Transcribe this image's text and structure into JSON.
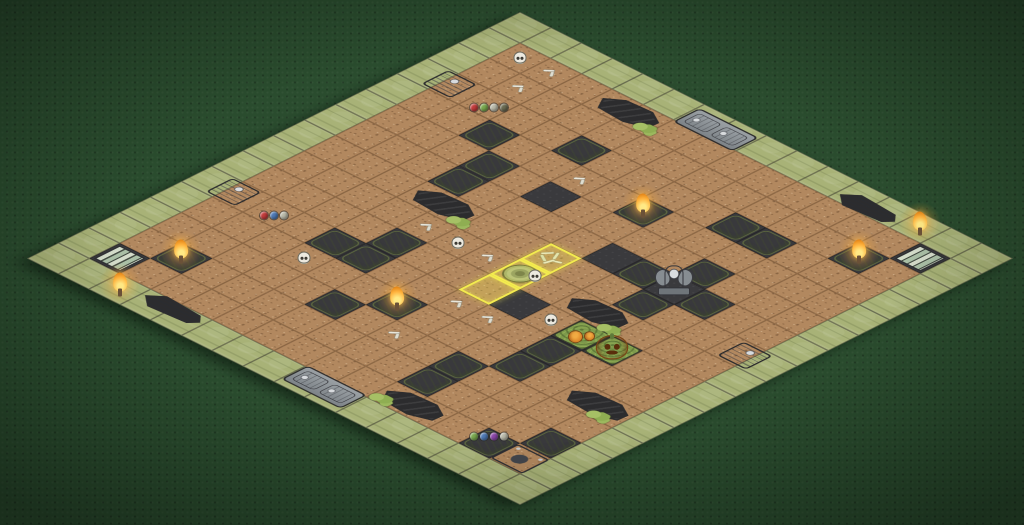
{
  "scene": {
    "description": "Isometric graveyard battle board on a dark green felt table",
    "board_theme": "graveyard",
    "grid_size": 16
  },
  "colors": {
    "felt": "#2a4c2e",
    "dirt": "#b2885f",
    "dark_square": "#3a3a3d",
    "moss_green": "#a8b277",
    "board_rim": "#2c2c2e",
    "board_edge_side": "#c8bda2",
    "water": "#6f7e89",
    "stone_gray": "#8f969c",
    "highlight_yellow": "#f4ec4f",
    "flame_orange": "#f5a02c",
    "pumpkin_orange": "#e89130"
  },
  "board": {
    "legend": {
      "E": "edge-moss-border",
      ".": "open-dirt",
      "D": "dark-blocked-square",
      "G": "moss-square",
      "T": "torch-moss-square",
      "S": "gate-striped-square",
      "P": "pumpkin-patch-square"
    },
    "rows": [
      "EEEEEEEEEEEEEEEE",
      "E.............SE",
      "E............T.E",
      "E....G....GG...E",
      "E..G....T......E",
      "E...G.D....G...E",
      "E...G....DGDG..E",
      "E..........G...E",
      "E..............E",
      "E....G...D.PP..E",
      "E...GG.....G...E",
      "E......T...G...E",
      "E.....G...G....E",
      "E.T.......G...GE",
      "ES...........G.E",
      "EEEEEEEEEEEEEEEE"
    ]
  },
  "highlight": {
    "color": "#f4ec4f",
    "cells": [
      {
        "i": 7,
        "j": 8,
        "content": "bone-pile"
      },
      {
        "i": 8,
        "j": 8,
        "content": "stone-well"
      },
      {
        "i": 9,
        "j": 8,
        "content": "empty"
      }
    ]
  },
  "flat_decorations": [
    {
      "kind": "pond",
      "i": 1,
      "j": 4,
      "dx": 0.5
    },
    {
      "kind": "pond",
      "i": 7,
      "j": 4,
      "dx": 0.5
    },
    {
      "kind": "pond",
      "i": 8,
      "j": 10,
      "dx": 0.5
    },
    {
      "kind": "pond",
      "i": 11,
      "j": 13,
      "dx": 0.5
    },
    {
      "kind": "pond",
      "i": 14,
      "j": 10,
      "dx": 0.5
    },
    {
      "kind": "coffin",
      "i": 0,
      "j": 11,
      "dx": 0.5,
      "dy": 0.22
    },
    {
      "kind": "coffin",
      "i": 15,
      "j": 3,
      "dx": 0.5,
      "dy": -0.22
    },
    {
      "kind": "tomb2",
      "i": 0,
      "j": 6,
      "dx": 0.5,
      "dy": 0.14
    },
    {
      "kind": "tomb2",
      "i": 15,
      "j": 8,
      "dx": 0.5,
      "dy": -0.14
    },
    {
      "kind": "tomb1",
      "i": 14,
      "j": 14
    },
    {
      "kind": "slab",
      "i": 3,
      "j": 1,
      "dx": -0.3
    },
    {
      "kind": "slab",
      "i": 10,
      "j": 1,
      "dx": -0.3
    },
    {
      "kind": "slab",
      "i": 7,
      "j": 14,
      "dx": 0.3
    },
    {
      "kind": "well",
      "i": 8,
      "j": 8
    },
    {
      "kind": "bonepile",
      "i": 7,
      "j": 8
    },
    {
      "kind": "moss",
      "i": 1,
      "j": 5,
      "dx": 0.3,
      "dy": 0.25
    },
    {
      "kind": "moss",
      "i": 7,
      "j": 5,
      "dx": 0.3,
      "dy": 0.3
    },
    {
      "kind": "moss",
      "i": 8,
      "j": 11,
      "dx": 0.25,
      "dy": 0.35
    },
    {
      "kind": "moss",
      "i": 11,
      "j": 14,
      "dx": -0.1,
      "dy": 0.35
    },
    {
      "kind": "moss",
      "i": 14,
      "j": 10,
      "dx": -0.2,
      "dy": 0.3
    },
    {
      "kind": "bones",
      "i": 1,
      "j": 2
    },
    {
      "kind": "bones",
      "i": 2,
      "j": 2
    },
    {
      "kind": "bones",
      "i": 4,
      "j": 6
    },
    {
      "kind": "bones",
      "i": 8,
      "j": 5
    },
    {
      "kind": "bones",
      "i": 8,
      "j": 7
    },
    {
      "kind": "bones",
      "i": 10,
      "j": 8
    },
    {
      "kind": "bones",
      "i": 10,
      "j": 9
    },
    {
      "kind": "bones",
      "i": 12,
      "j": 8
    }
  ],
  "upright_decorations": [
    {
      "kind": "flame",
      "i": 0,
      "j": 13,
      "oy": -4
    },
    {
      "kind": "flame",
      "i": 15,
      "j": 2,
      "oy": -4
    },
    {
      "kind": "flame",
      "i": 4,
      "j": 8,
      "oy": -6
    },
    {
      "kind": "flame",
      "i": 11,
      "j": 7,
      "oy": -6
    },
    {
      "kind": "flame",
      "i": 13,
      "j": 2,
      "oy": -6
    },
    {
      "kind": "flame",
      "i": 2,
      "j": 13,
      "oy": -6
    },
    {
      "kind": "skull",
      "i": 1,
      "j": 1
    },
    {
      "kind": "skull",
      "i": 8,
      "j": 6
    },
    {
      "kind": "skull",
      "i": 9,
      "j": 10
    },
    {
      "kind": "skull",
      "i": 11,
      "j": 4
    },
    {
      "kind": "skull",
      "i": 8,
      "j": 8,
      "ox": 15,
      "oy": 2
    },
    {
      "kind": "monument",
      "i": 6,
      "j": 11,
      "oy": -8
    },
    {
      "kind": "pumpkin-big",
      "i": 9,
      "j": 12,
      "oy": -4
    },
    {
      "kind": "pumpkin-small",
      "i": 9,
      "j": 11
    },
    {
      "kind": "potions",
      "i": 3,
      "j": 2,
      "colors": [
        "#c23b3b",
        "#79a84e",
        "#b9b9a9",
        "#6b6b52"
      ]
    },
    {
      "kind": "potions",
      "i": 10,
      "j": 2,
      "colors": [
        "#c23b3b",
        "#4e79b5",
        "#b9b9a9"
      ]
    },
    {
      "kind": "potions",
      "i": 14,
      "j": 13,
      "oy": -10,
      "colors": [
        "#79a84e",
        "#4e79b5",
        "#8a46a8",
        "#b9b9a9"
      ]
    }
  ]
}
